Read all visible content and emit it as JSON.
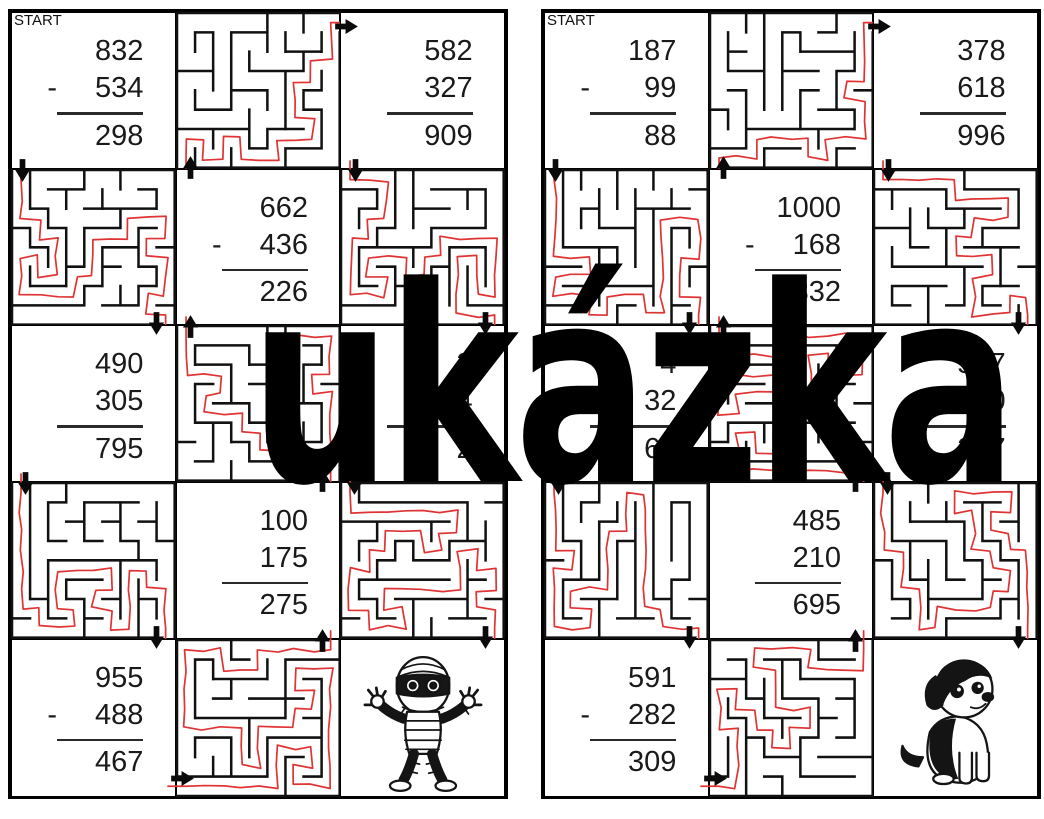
{
  "watermark": {
    "text": "ukázka"
  },
  "labels": {
    "start": "START"
  },
  "colors": {
    "path_red": "#e03434",
    "wall_black": "#111111",
    "ink": "#1a1a1a"
  },
  "panels": [
    {
      "side": "left",
      "mascot": "mummy",
      "problems": {
        "r0c0": {
          "top": "832",
          "op": "-",
          "mid": "534",
          "ans": "298"
        },
        "r0c2": {
          "top": "582",
          "op": "",
          "mid": "327",
          "ans": "909"
        },
        "r1c1": {
          "top": "662",
          "op": "-",
          "mid": "436",
          "ans": "226"
        },
        "r2c0": {
          "top": "490",
          "op": "",
          "mid": "305",
          "ans": "795"
        },
        "r2c2": {
          "top": "3",
          "op": "",
          "mid": "4",
          "ans": "2",
          "obscured": true
        },
        "r3c1": {
          "top": "100",
          "op": "",
          "mid": "175",
          "ans": "275"
        },
        "r4c0": {
          "top": "955",
          "op": "-",
          "mid": "488",
          "ans": "467"
        }
      }
    },
    {
      "side": "right",
      "mascot": "dog",
      "problems": {
        "r0c0": {
          "top": "187",
          "op": "-",
          "mid": "99",
          "ans": "88"
        },
        "r0c2": {
          "top": "378",
          "op": "",
          "mid": "618",
          "ans": "996"
        },
        "r1c1": {
          "top": "1000",
          "op": "-",
          "mid": "168",
          "ans": "832"
        },
        "r2c0": {
          "top": "4",
          "op": "",
          "mid": "32",
          "ans": "66",
          "obscured": true
        },
        "r2c2": {
          "top": "517",
          "op": "-",
          "mid": "300",
          "ans": "217"
        },
        "r3c1": {
          "top": "485",
          "op": "",
          "mid": "210",
          "ans": "695"
        },
        "r4c0": {
          "top": "591",
          "op": "-",
          "mid": "282",
          "ans": "309"
        }
      }
    }
  ]
}
